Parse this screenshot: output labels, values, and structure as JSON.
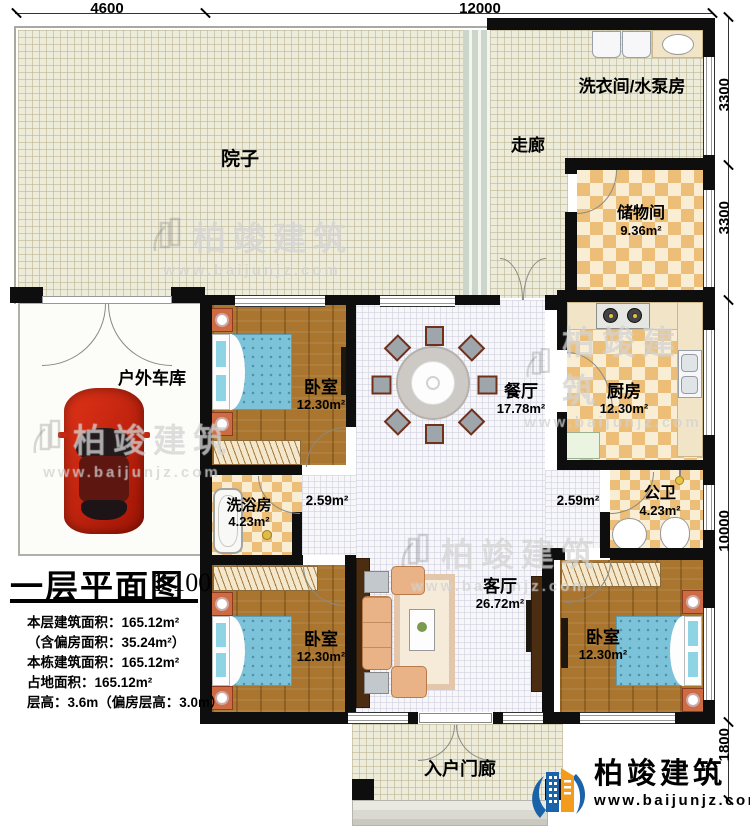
{
  "plan": {
    "title": "一层平面图",
    "scale": "1:100",
    "stats": [
      "本层建筑面积：165.12m²",
      "（含偏房面积：35.24m²）",
      "本栋建筑面积：165.12m²",
      "占地面积：165.12m²",
      "层高：3.6m（偏房层高：3.0m）"
    ]
  },
  "dimensions": {
    "top": [
      "4600",
      "12000"
    ],
    "right": [
      "3300",
      "3300",
      "10000",
      "1800"
    ]
  },
  "rooms": {
    "courtyard": {
      "name": "院子"
    },
    "laundry": {
      "name": "洗衣间/水泵房"
    },
    "corridor": {
      "name": "走廊"
    },
    "storage": {
      "name": "储物间",
      "area": "9.36m²"
    },
    "garage": {
      "name": "户外车库"
    },
    "bedroom_top": {
      "name": "卧室",
      "area": "12.30m²"
    },
    "dining": {
      "name": "餐厅",
      "area": "17.78m²"
    },
    "kitchen": {
      "name": "厨房",
      "area": "12.30m²"
    },
    "bath": {
      "name": "洗浴房",
      "area": "4.23m²"
    },
    "hall_left": {
      "area": "2.59m²"
    },
    "hall_right": {
      "area": "2.59m²"
    },
    "toilet": {
      "name": "公卫",
      "area": "4.23m²"
    },
    "living": {
      "name": "客厅",
      "area": "26.72m²"
    },
    "bedroom_left": {
      "name": "卧室",
      "area": "12.30m²"
    },
    "bedroom_right": {
      "name": "卧室",
      "area": "12.30m²"
    },
    "porch": {
      "name": "入户门廊"
    }
  },
  "branding": {
    "company": "柏竣建筑",
    "website": "www.baijunjz.com"
  },
  "watermark": {
    "company": "柏竣建筑",
    "website": "www.baijunjz.com"
  },
  "colors": {
    "wall": "#0e0e0e",
    "wood": "#a9752f",
    "tile_orange": "#ecbe77",
    "bed_blue": "#7cc3da",
    "logo_blue": "#1a63a8",
    "logo_orange": "#f29b1d",
    "car_red": "#c81e0e"
  }
}
